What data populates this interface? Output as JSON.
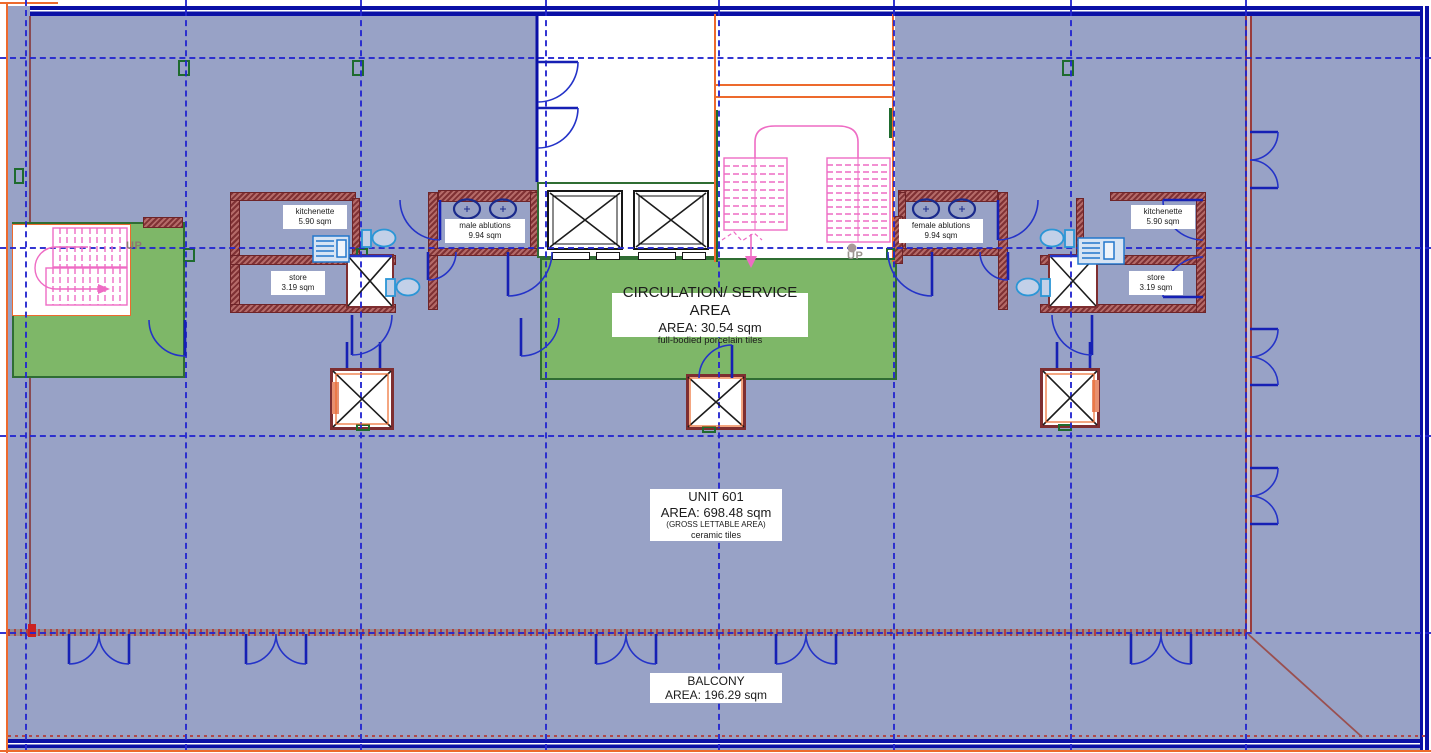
{
  "plan": {
    "rooms": {
      "circulation": {
        "name": "CIRCULATION/ SERVICE AREA",
        "area": "AREA: 30.54 sqm",
        "finish": "full-bodied porcelain tiles"
      },
      "unit": {
        "name": "UNIT 601",
        "area": "AREA: 698.48 sqm",
        "note": "(GROSS LETTABLE AREA)",
        "finish": "ceramic tiles"
      },
      "balcony": {
        "name": "BALCONY",
        "area": "AREA: 196.29 sqm"
      },
      "kitchenette_left": {
        "name": "kitchenette",
        "area": "5.90 sqm"
      },
      "store_left": {
        "name": "store",
        "area": "3.19 sqm"
      },
      "male_ablutions": {
        "name": "male ablutions",
        "area": "9.94 sqm"
      },
      "female_ablutions": {
        "name": "female ablutions",
        "area": "9.94 sqm"
      },
      "kitchenette_right": {
        "name": "kitchenette",
        "area": "5.90 sqm"
      },
      "store_right": {
        "name": "store",
        "area": "3.19 sqm"
      }
    },
    "annotations": {
      "stair_left_direction": "UP",
      "stair_center_direction": "UP"
    },
    "colors": {
      "floor": "#98a2c6",
      "circulation_green": "#7eb768",
      "wall_red": "#a05254",
      "stair_pink": "#ee6cc4",
      "grid_blue": "#2326cf",
      "door_blue": "#2433c8",
      "window_navy": "#0a10a6",
      "boundary_orange": "#ed6a2d"
    }
  }
}
